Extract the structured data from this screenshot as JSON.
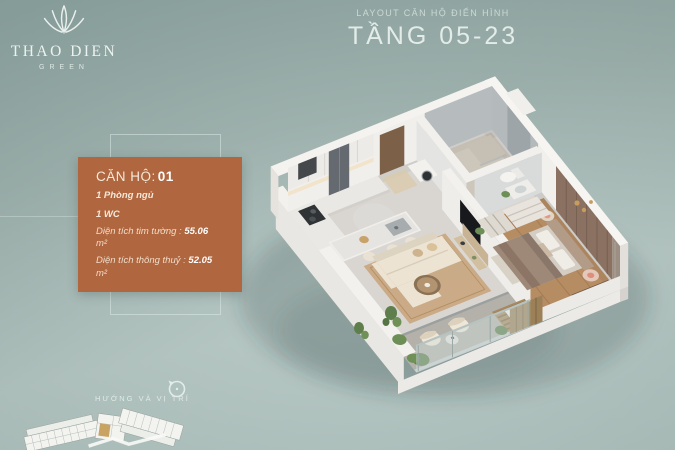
{
  "background": {
    "top_color": "#8da5a1",
    "bottom_color": "#b3c6c2"
  },
  "brand": {
    "name": "THAO DIEN",
    "sub": "GREEN",
    "emblem_icon": "lotus-emblem-icon",
    "text_color": "#ecf2ef"
  },
  "header": {
    "eyebrow": "LAYOUT CĂN HỘ ĐIỂN HÌNH",
    "title": "TẦNG 05-23"
  },
  "unit_card": {
    "bg_color": "#b0663f",
    "label": "CĂN HỘ:",
    "number": "01",
    "features": [
      "1 Phòng ngủ",
      "1 WC"
    ],
    "areas": [
      {
        "label": "Diện tích tim tường :",
        "value": "55.06",
        "unit": "m²"
      },
      {
        "label": "Diện tích thông thuỷ :",
        "value": "52.05",
        "unit": "m²"
      }
    ]
  },
  "floor_plan": {
    "description": "isometric 3D render of typical apartment unit",
    "wood_floor_color": "#b68c62",
    "tile_floor_color": "#d9d6d2",
    "accent_wall_color": "#8a7161",
    "sofa_color": "#ece3d2",
    "rug_color": "#c7a47c"
  },
  "footer": {
    "direction_label": "HƯỚNG VÀ VỊ TRÍ",
    "compass_icon": "compass-north-icon",
    "minimap": {
      "icon": "site-plan-minimap",
      "highlight_color": "#c9a362",
      "building_color": "#f3f3ef"
    }
  }
}
